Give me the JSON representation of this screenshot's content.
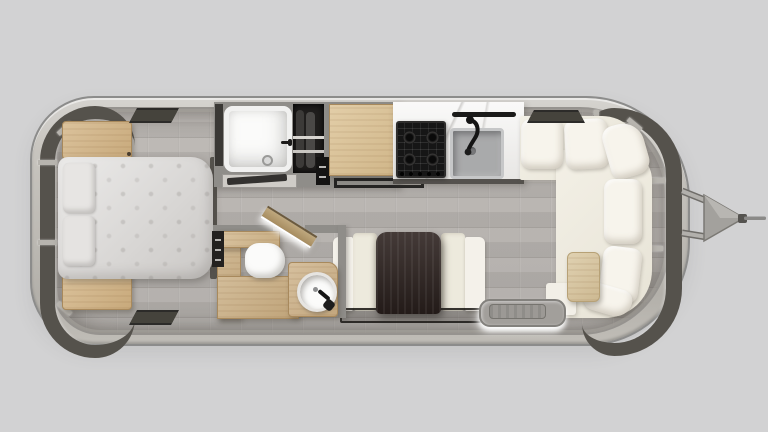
{
  "scene": {
    "type": "travel-trailer-floor-plan",
    "view": "top-down-render",
    "text_visible": "none"
  },
  "palette": {
    "bg": "#d2d2d3",
    "shell": "#c7c4be",
    "shell-outline": "#8c8c8b",
    "wall": "#8f8d89",
    "floor": "#b6b2ae",
    "window-tint": "#55524c",
    "wood-light": "#dcc395",
    "wood-medium": "#d3b586",
    "table-dark-wood": "#2f2421",
    "mattress": "#dcdad8",
    "sofa-seat": "#efebe0",
    "sofa-cushion": "#f7f4ec",
    "marble": "#f2f1ef",
    "appliance-black": "#161616",
    "sink-gray": "#a9aaab",
    "fixture-white": "#fbfbfa",
    "step-glow": "#ffffff"
  },
  "inventory": [
    "trailer-shell",
    "hitch-tongue",
    "rear-wrap-windows",
    "front-wrap-windows",
    "bed",
    "pillows",
    "nightstand-rear-top",
    "nightstand-rear-bottom",
    "roof-vent-bedroom-top",
    "roof-vent-bedroom-bottom",
    "roof-vent-front",
    "shower",
    "wardrobe",
    "overhead-cabinet",
    "towel-rack",
    "cooktop",
    "kitchen-sink",
    "kitchen-faucet",
    "towel-bar",
    "marble-counter",
    "bathroom-door",
    "toilet",
    "bath-sink",
    "vanity",
    "dinette-table",
    "dinette-bench-left",
    "dinette-bench-right",
    "floor-mat",
    "lounge-sofa",
    "lounge-back-cushions",
    "chaise-table",
    "entry-step"
  ]
}
